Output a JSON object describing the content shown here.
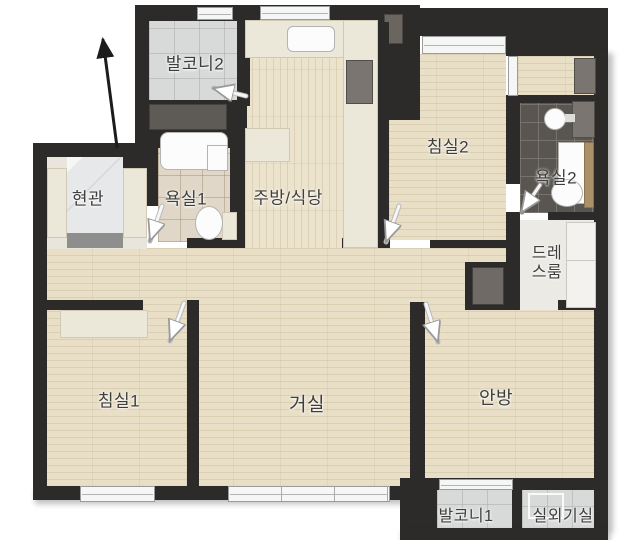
{
  "floorplan": {
    "type": "apartment-floor-plan",
    "rooms": [
      {
        "id": "balcony-2",
        "label": "발코니2"
      },
      {
        "id": "entrance",
        "label": "현관"
      },
      {
        "id": "bathroom-1",
        "label": "욕실1"
      },
      {
        "id": "kitchen-dining",
        "label": "주방/식당"
      },
      {
        "id": "bedroom-2",
        "label": "침실2"
      },
      {
        "id": "bathroom-2",
        "label": "욕실2"
      },
      {
        "id": "dress-room",
        "label": "드레스룸"
      },
      {
        "id": "bedroom-1",
        "label": "침실1"
      },
      {
        "id": "living-room",
        "label": "거실"
      },
      {
        "id": "master-bedroom",
        "label": "안방"
      },
      {
        "id": "balcony-1",
        "label": "발코니1"
      },
      {
        "id": "outdoor-unit-room",
        "label": "실외기실"
      }
    ],
    "colors": {
      "wall": "#2d2b29",
      "wood_floor": "#e9dfc7",
      "balcony_tile": "#d8d9d9",
      "bathroom1_tile": "#e0d7c9",
      "bathroom2_tile": "#595651",
      "counter": "#ebe7d9",
      "label_text": "#3f3e3c"
    }
  }
}
